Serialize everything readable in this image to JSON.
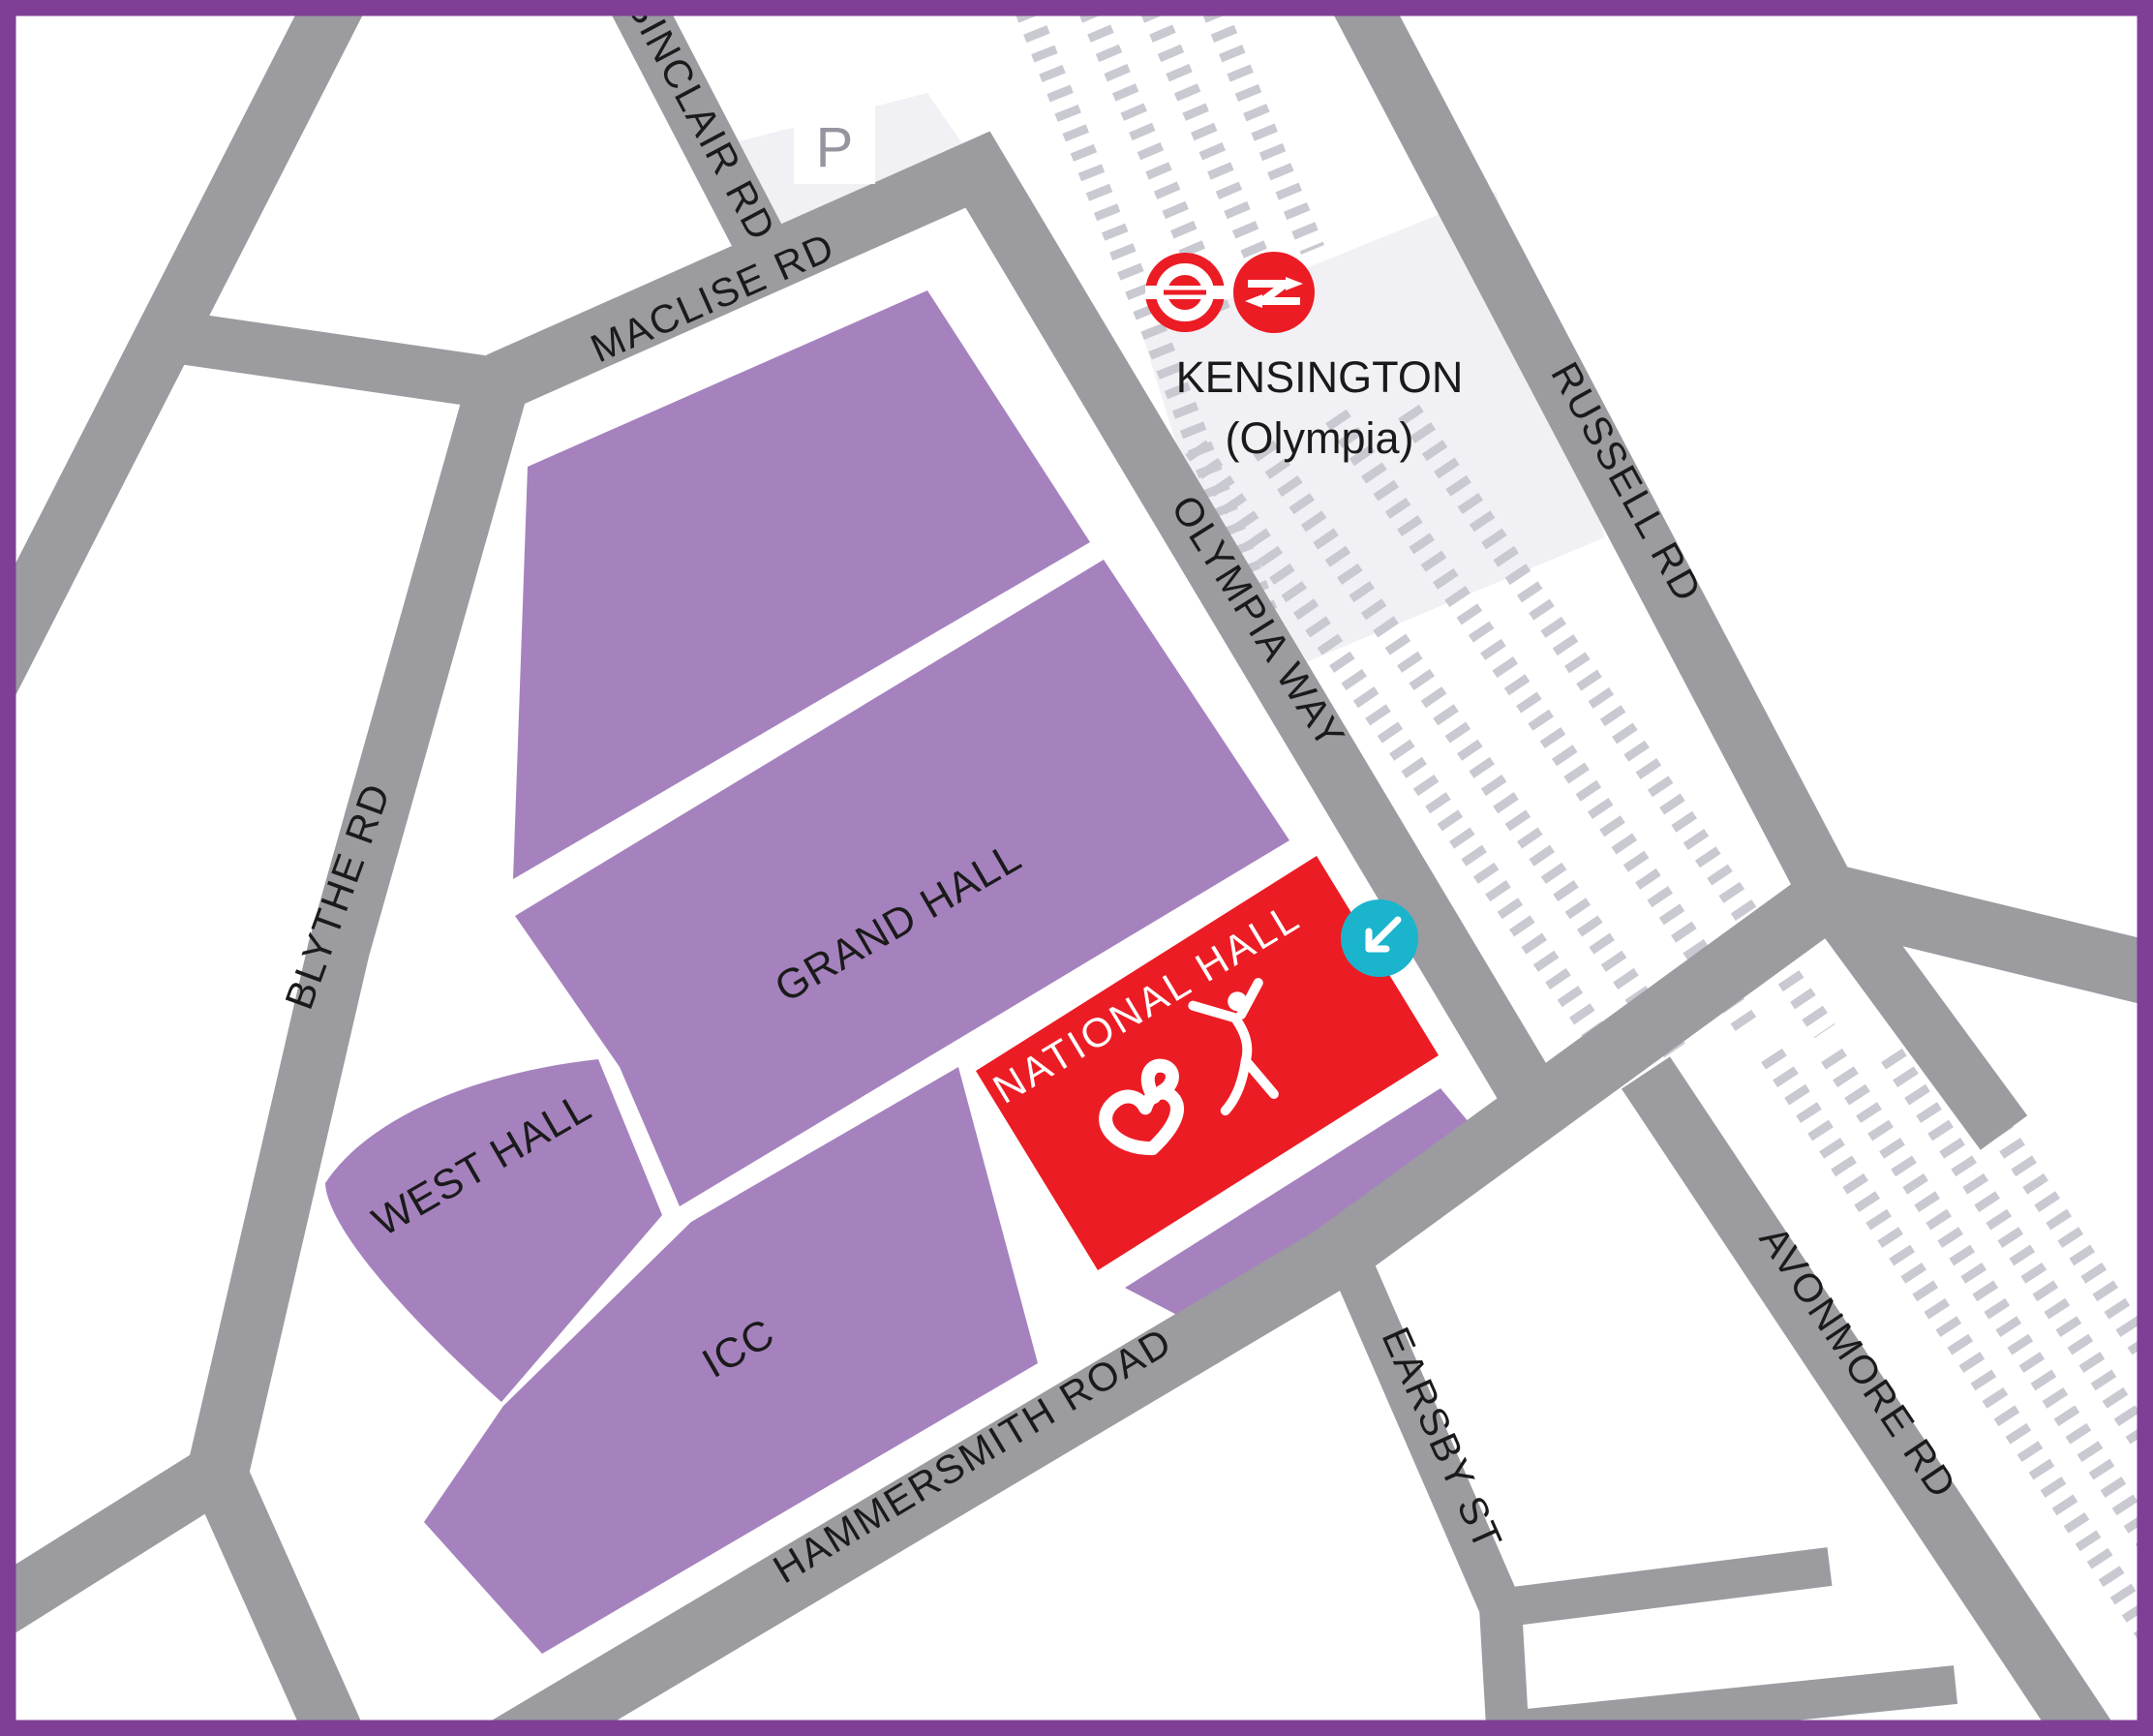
{
  "map": {
    "venue": "Olympia London venue map",
    "streets": {
      "sinclair": "SINCLAIR RD",
      "maclise": "MACLISE RD",
      "blythe": "BLYTHE RD",
      "olympia_way": "OLYMPIA WAY",
      "russell": "RUSSELL RD",
      "hammersmith": "HAMMERSMITH ROAD",
      "earsby": "EARSBY ST",
      "avonmore": "AVONMORE RD"
    },
    "halls": {
      "grand": "GRAND HALL",
      "west": "WEST HALL",
      "icc": "ICC",
      "national": "NATIONAL HALL"
    },
    "station": {
      "line1": "KENSINGTON",
      "line2": "(Olympia)",
      "icons": [
        "london-underground-roundel",
        "national-rail-double-arrow"
      ]
    },
    "parking": {
      "label": "P"
    },
    "entrance_marker": {
      "icon": "arrow-down-left"
    },
    "logos": [
      "olympia-heart-logo",
      "gymnast-figure"
    ],
    "colors": {
      "border_purple": "#7f3f97",
      "hall_purple": "#a582bd",
      "highlight_red": "#ec1c24",
      "entrance_teal": "#1ab4cd",
      "street_gray": "#9b9ba0",
      "rail_track_gray": "#c9c9d2",
      "station_area_gray": "#f1f1f5",
      "label_black": "#1a1a1a",
      "white": "#ffffff"
    }
  }
}
